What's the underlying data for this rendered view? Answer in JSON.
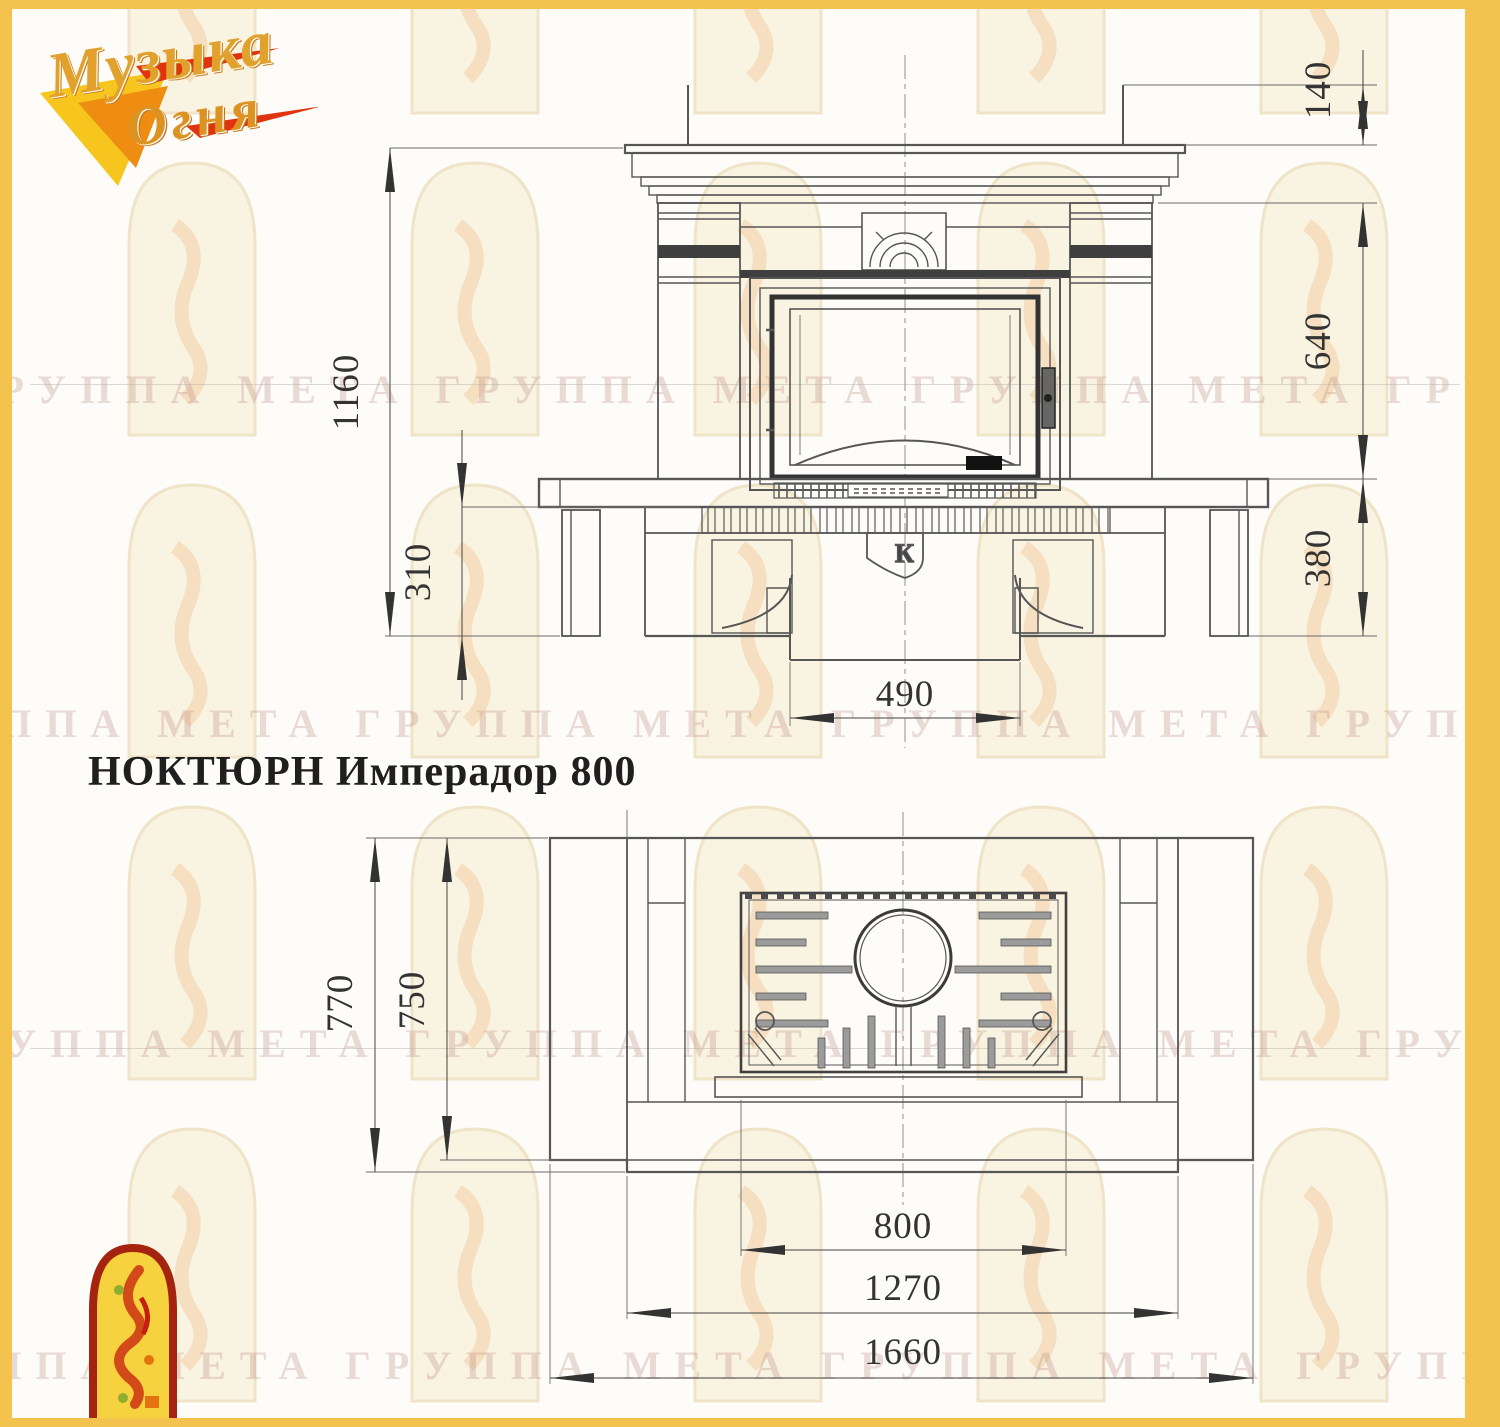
{
  "logo": {
    "line1": "Музыка",
    "line2": "Огня"
  },
  "title": "НОКТЮРН Имперадор 800",
  "watermark": {
    "row_text": "ГРУППА МЕТА ГРУППА МЕТА ГРУППА МЕТА ГРУППА МЕТА ГРУППА МЕТА"
  },
  "front_view": {
    "label": "front elevation of fireplace",
    "emblem": "К",
    "dims": {
      "h_total": "1160",
      "h_base": "310",
      "h_mantel": "140",
      "h_opening": "640",
      "h_bench": "380",
      "w_base": "490"
    }
  },
  "plan_view": {
    "label": "top plan of fireplace",
    "dims": {
      "d_total": "770",
      "d_body": "750",
      "w_firebox": "800",
      "w_body": "1270",
      "w_total": "1660"
    }
  },
  "colors": {
    "border": "#f3c24f",
    "logo_gold": "#e2a02c",
    "logo_red": "#d8310e",
    "line": "#565656",
    "dark": "#3b3b3b",
    "watermark_text": "#bc8c82",
    "arch_fill": "#f8f1dd"
  }
}
